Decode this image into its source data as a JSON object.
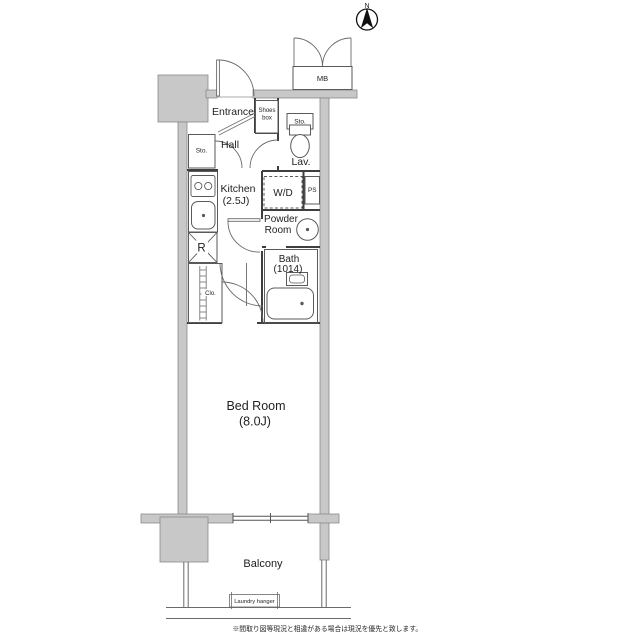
{
  "compass": {
    "north": "N"
  },
  "labels": {
    "mb": "MB",
    "entrance": "Entrance",
    "shoes_1": "Shoes",
    "shoes_2": "box",
    "sto_hall": "Sto.",
    "sto_lav": "Sto.",
    "hall": "Hall",
    "lav": "Lav.",
    "kitchen_1": "Kitchen",
    "kitchen_2": "(2.5J)",
    "wd": "W/D",
    "ps": "PS",
    "powder_1": "Powder",
    "powder_2": "Room",
    "bath_1": "Bath",
    "bath_2": "(1014)",
    "fridge": "R",
    "closet": "Clo.",
    "bedroom_1": "Bed Room",
    "bedroom_2": "(8.0J)",
    "balcony": "Balcony",
    "laundry_hanger": "Laundry hanger",
    "note": "※間取り図等現況と相違がある場合は現況を優先と致します。"
  },
  "colors": {
    "wall_fill": "#c8c8c8",
    "wall_edge": "#8a8a8a",
    "partition": "#3f3f3f",
    "fixture_line": "#5a5a5a",
    "text": "#1f1f1f"
  }
}
